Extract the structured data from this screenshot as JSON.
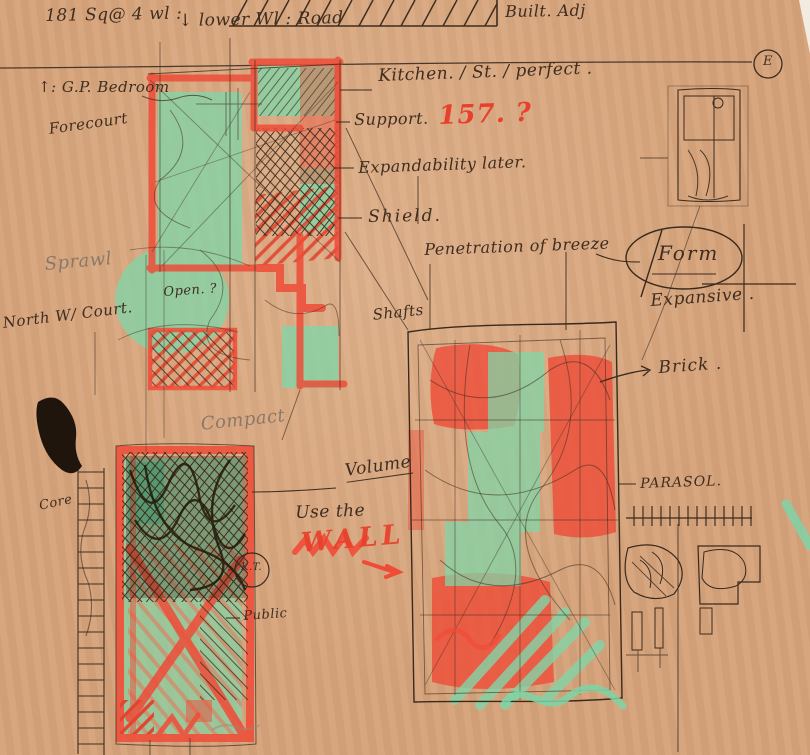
{
  "meta": {
    "description": "Hand-drawn architectural concept sketch on kraft paper"
  },
  "palette": {
    "paper": "#d6a37a",
    "pen": "#3e2d20",
    "red_marker": "#ef4c38",
    "green_marker": "#82d5a7",
    "pencil": "#8a7868",
    "ink_blob": "#1f150d"
  },
  "annotations": {
    "area": {
      "text": "181 Sq@ 4 wl :"
    },
    "level": {
      "text": "↓  lower Wl :   Road"
    },
    "built_adj": {
      "text": "Built. Adj"
    },
    "bedroom": {
      "text": "↑:  G.P. Bedroom"
    },
    "forecourt": {
      "text": "Forecourt"
    },
    "kitchen": {
      "text": "Kitchen. / St. / perfect ."
    },
    "support": {
      "text": "Support."
    },
    "support_num": {
      "text": "157. ?"
    },
    "expandability": {
      "text": "Expandability later."
    },
    "shield": {
      "text": "Shield."
    },
    "penetration": {
      "text": "Penetration of breeze"
    },
    "form": {
      "text": "Form"
    },
    "expansive": {
      "text": "Expansive ."
    },
    "shafts": {
      "text": "Shafts"
    },
    "sprawl": {
      "text": "Sprawl"
    },
    "north_court": {
      "text": "North W/ Court."
    },
    "open_q": {
      "text": "Open. ?"
    },
    "brick": {
      "text": "Brick ."
    },
    "compact": {
      "text": "Compact"
    },
    "volume": {
      "text": "Volume"
    },
    "use_the": {
      "text": "Use the"
    },
    "wall": {
      "text": "WALL"
    },
    "parasol": {
      "text": "PARASOL."
    },
    "core": {
      "text": "Core"
    },
    "kt": {
      "text": "K.T."
    },
    "public": {
      "text": "Public"
    },
    "east": {
      "text": "E"
    }
  }
}
